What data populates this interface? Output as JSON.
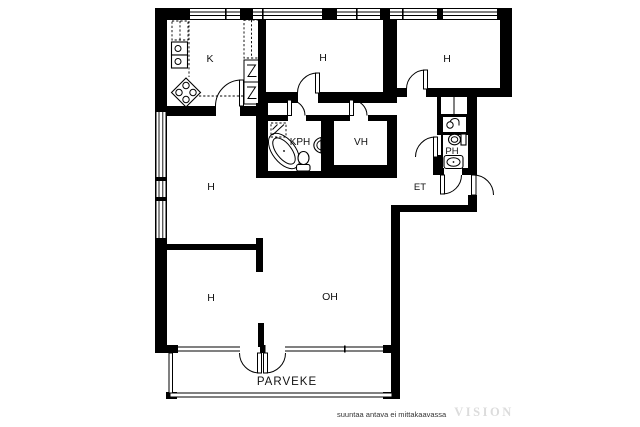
{
  "plan": {
    "type": "apartment-floor-plan",
    "rooms": [
      {
        "name": "kitchen",
        "label": "K"
      },
      {
        "name": "bedroom-top-middle",
        "label": "H"
      },
      {
        "name": "bedroom-top-right",
        "label": "H"
      },
      {
        "name": "bathroom",
        "label": "KPH"
      },
      {
        "name": "walk-in-closet",
        "label": "VH"
      },
      {
        "name": "toilet",
        "label": "PH"
      },
      {
        "name": "entry-hall",
        "label": "ET"
      },
      {
        "name": "hall",
        "label": "H"
      },
      {
        "name": "bedroom-bottom-left",
        "label": "H"
      },
      {
        "name": "living-room",
        "label": "OH"
      },
      {
        "name": "balcony",
        "label": "PARVEKE"
      }
    ],
    "caption": "suuntaa antava ei mittakaavassa",
    "watermark": "VISION"
  },
  "colors": {
    "wall": "#000000",
    "floor": "#ffffff",
    "label": "#111111",
    "caption": "#333333",
    "watermark": "#dcdcdc"
  }
}
